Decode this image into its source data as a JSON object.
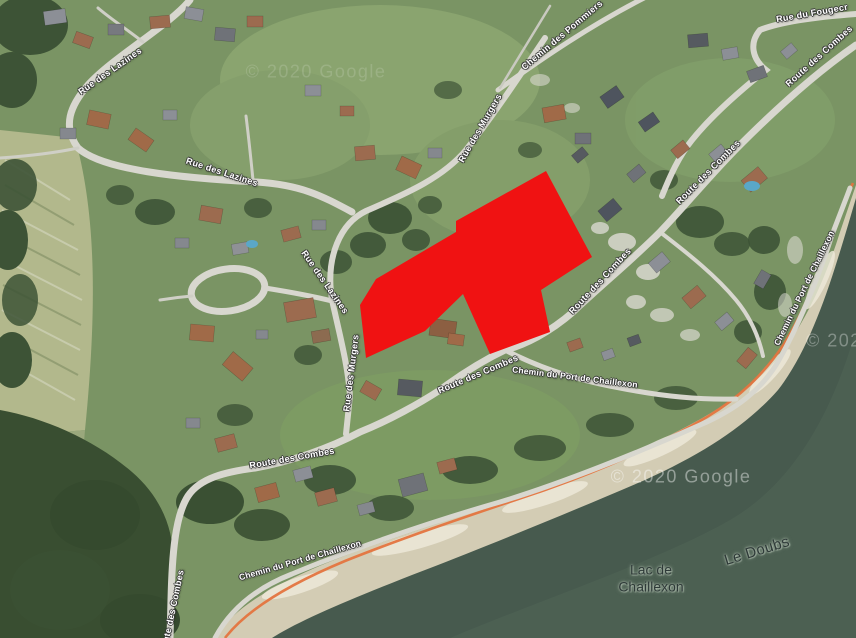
{
  "overlay": {
    "color": "#f01212",
    "points": "546,171 592,257 541,290 550,332 490,354 463,294 425,331 366,358 360,305 376,279 456,232 456,221"
  },
  "road_labels": [
    {
      "text": "Rue des Lazines"
    },
    {
      "text": "Rue des Lazines"
    },
    {
      "text": "Rue des Lazines"
    },
    {
      "text": "Rue des Murgers"
    },
    {
      "text": "Rue des Murgers"
    },
    {
      "text": "Chemin des Pommiers"
    },
    {
      "text": "Rue du Fougecr"
    },
    {
      "text": "Route des Combes"
    },
    {
      "text": "Route des Combes"
    },
    {
      "text": "Route des Combes"
    },
    {
      "text": "Route des Combes"
    },
    {
      "text": "Route des Combes"
    },
    {
      "text": "Route des Combes"
    },
    {
      "text": "Chemin du Port de Chaillexon"
    },
    {
      "text": "Chemin du Port de Chaillexon"
    },
    {
      "text": "Chemin du Port de Chaillexon"
    }
  ],
  "water_labels": [
    {
      "text": "Lac de Chaillexon"
    },
    {
      "text": "Le Doubs"
    }
  ],
  "watermarks": [
    {
      "text": "© 2020 Google"
    },
    {
      "text": "© 2020 Google"
    },
    {
      "text": "© 2020 Google"
    }
  ]
}
